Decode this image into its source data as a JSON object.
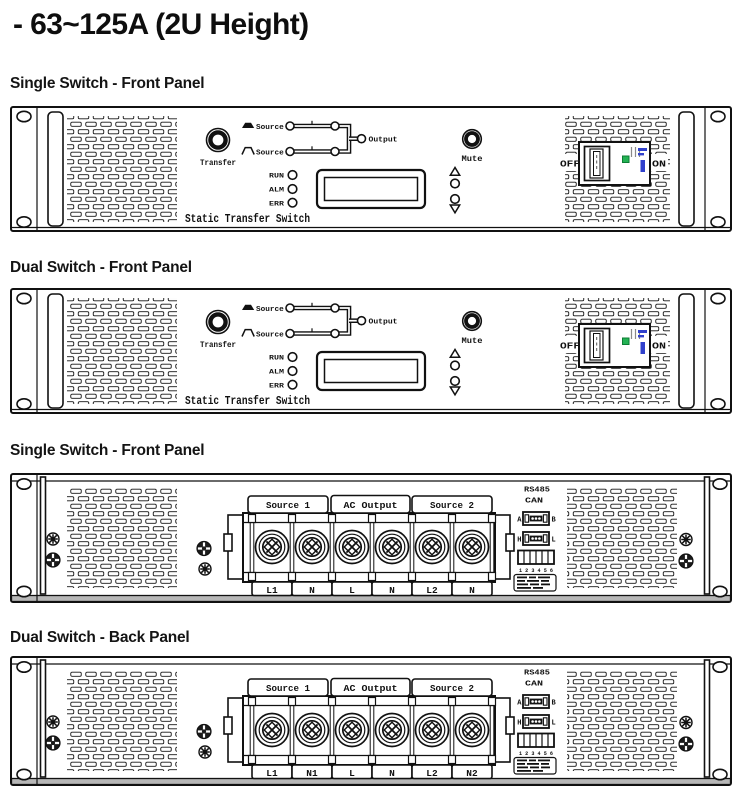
{
  "page": {
    "title": "- 63~125A (2U Height)"
  },
  "sections": [
    {
      "label": "Single Switch - Front Panel"
    },
    {
      "label": "Dual Switch - Front Panel"
    },
    {
      "label": "Single Switch - Front Panel"
    },
    {
      "label": "Dual Switch - Back Panel"
    }
  ],
  "front_panel": {
    "transfer_label": "Transfer",
    "source1_label": "Source 1",
    "source2_label": "Source 2",
    "output_label": "Output",
    "leds": [
      "RUN",
      "ALM",
      "ERR"
    ],
    "mute_label": "Mute",
    "off_label": "OFF",
    "on_label": "ON",
    "brand_label": "Static Transfer Switch"
  },
  "back_panel": {
    "rs485_label": "RS485",
    "can_label": "CAN",
    "port_ab": {
      "left": "A",
      "right": "B"
    },
    "port_hl": {
      "left": "H",
      "right": "L"
    },
    "dip_numbers": "1 2 3 4 5 6",
    "groups": [
      "Source 1",
      "AC Output",
      "Source 2"
    ],
    "single_terminals": [
      "L1",
      "N",
      "L",
      "N",
      "L2",
      "N"
    ],
    "dual_terminals": [
      "L1",
      "N1",
      "L",
      "N",
      "L2",
      "N2"
    ]
  },
  "colors": {
    "line": "#111111",
    "breaker_green": "#24b254",
    "breaker_blue": "#3040cc",
    "rail_gray": "#b7b7b7"
  }
}
